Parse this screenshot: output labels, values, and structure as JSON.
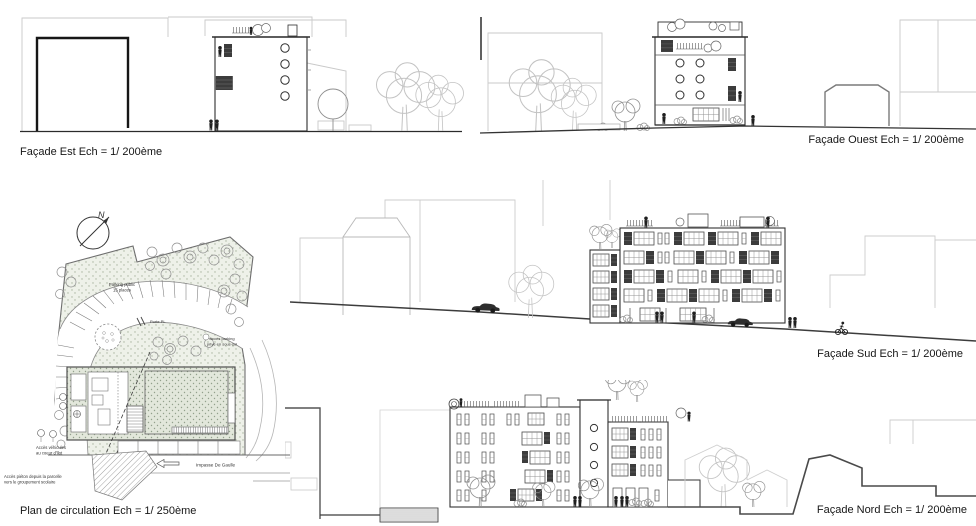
{
  "sheet": {
    "background": "#ffffff",
    "ink": "#2e2e2e",
    "context_line": "#c9c9c9",
    "vegetation_tone": "#aebfa5"
  },
  "captions": {
    "facade_est": "Façade Est Ech = 1/ 200ème",
    "facade_ouest": "Façade Ouest Ech = 1/ 200ème",
    "facade_sud": "Façade Sud Ech = 1/ 200ème",
    "facade_nord": "Façade Nord Ech = 1/ 200ème",
    "plan": "Plan de circulation Ech = 1/ 250ème"
  },
  "plan": {
    "compass_letter": "N",
    "annotations": {
      "parking_public_line1": "Parking public",
      "parking_public_line2": "15 places",
      "porte_pl": "Porte PL",
      "acces_parking_line1": "Accès parking",
      "acces_parking_line2": "privé en sous-sol",
      "acces_vehicules_line1": "Accès véhicules",
      "acces_vehicules_line2": "au coeur d'îlot",
      "acces_pieton_line1": "Accès piéton depuis la parcelle",
      "acces_pieton_line2": "vers le groupement scolaire",
      "street_name": "Impasse De Gaulle"
    }
  }
}
